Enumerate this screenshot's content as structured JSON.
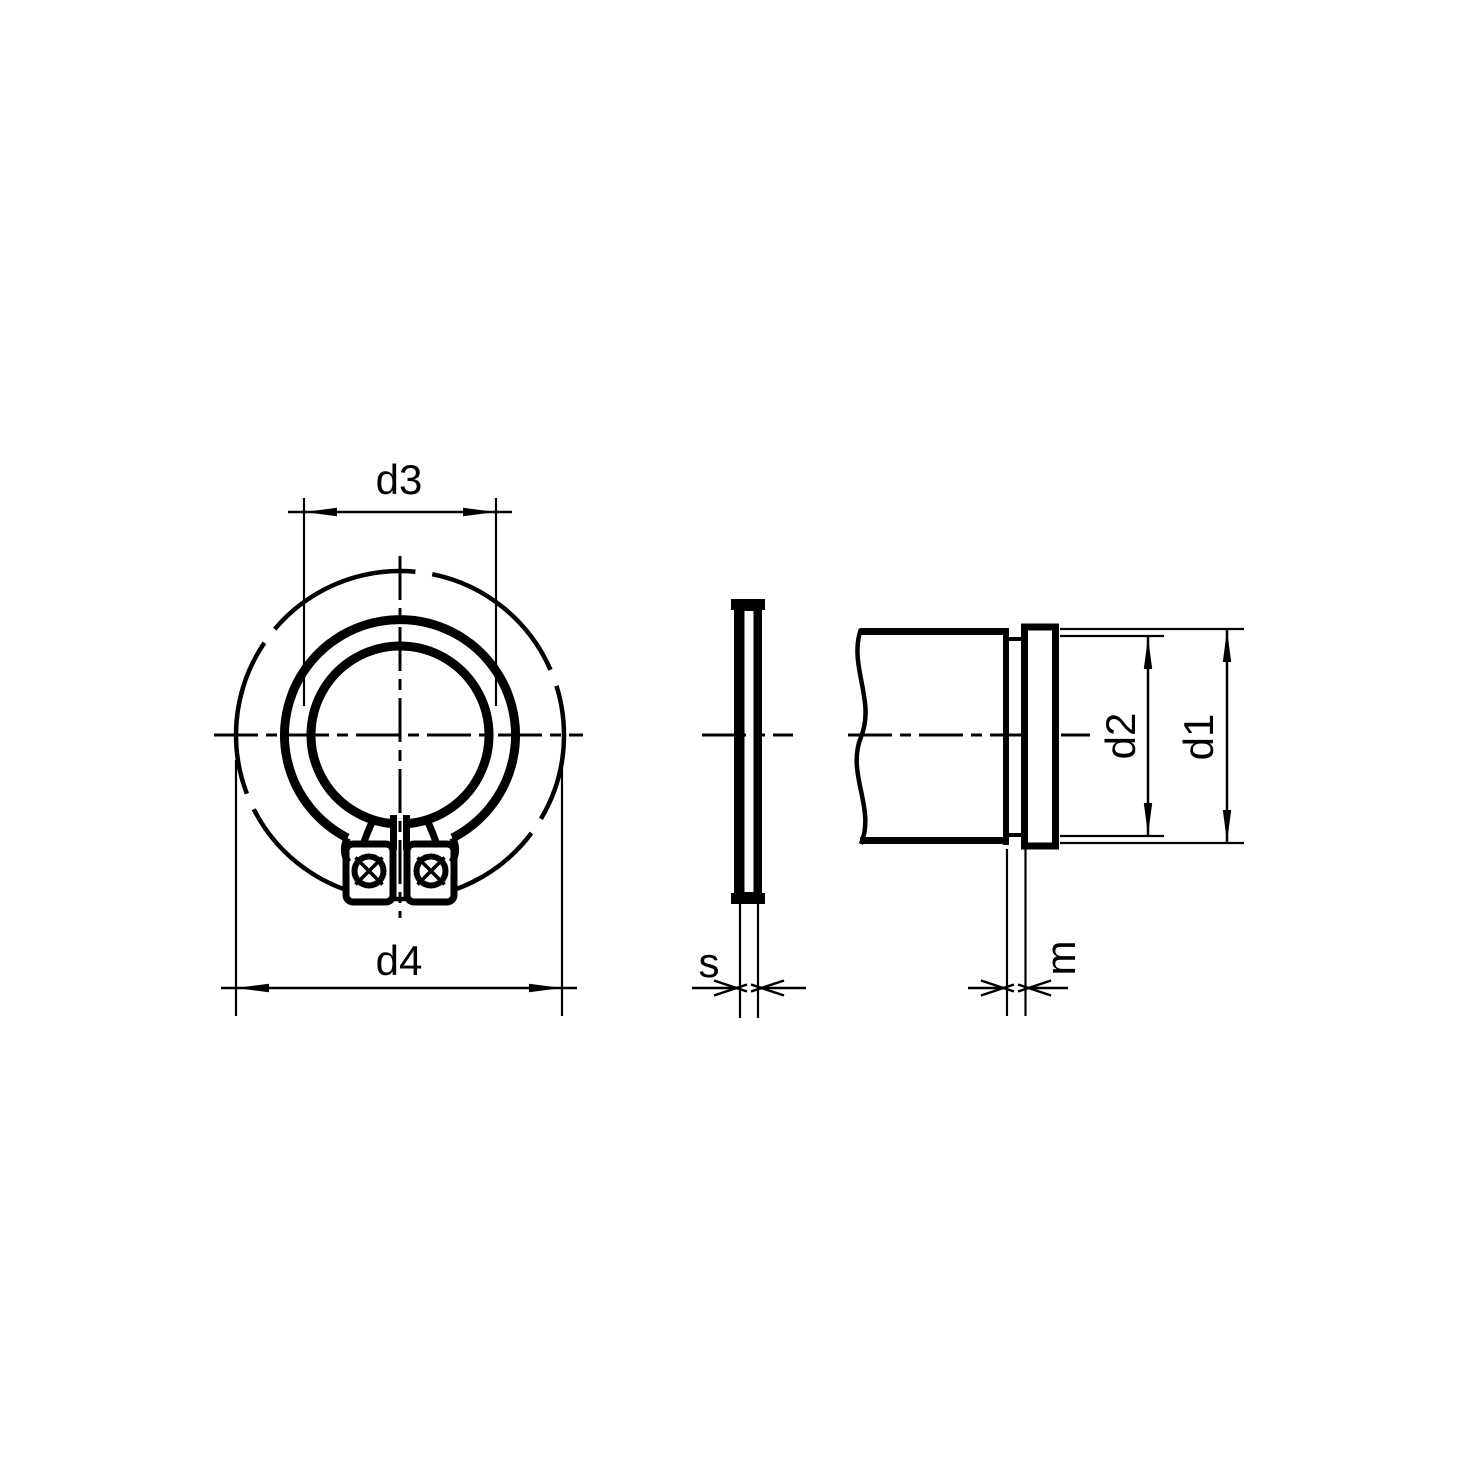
{
  "drawing": {
    "kind": "external-retaining-ring-technical-drawing",
    "colors": {
      "line": "#000000",
      "background": "#ffffff"
    },
    "views": {
      "front": {
        "dim_inner_diameter": "d3",
        "dim_outer_diameter": "d4"
      },
      "side": {
        "dim_thickness": "s"
      },
      "shaft": {
        "dim_groove_diameter": "d2",
        "dim_shaft_diameter": "d1",
        "dim_groove_width": "m"
      }
    }
  }
}
